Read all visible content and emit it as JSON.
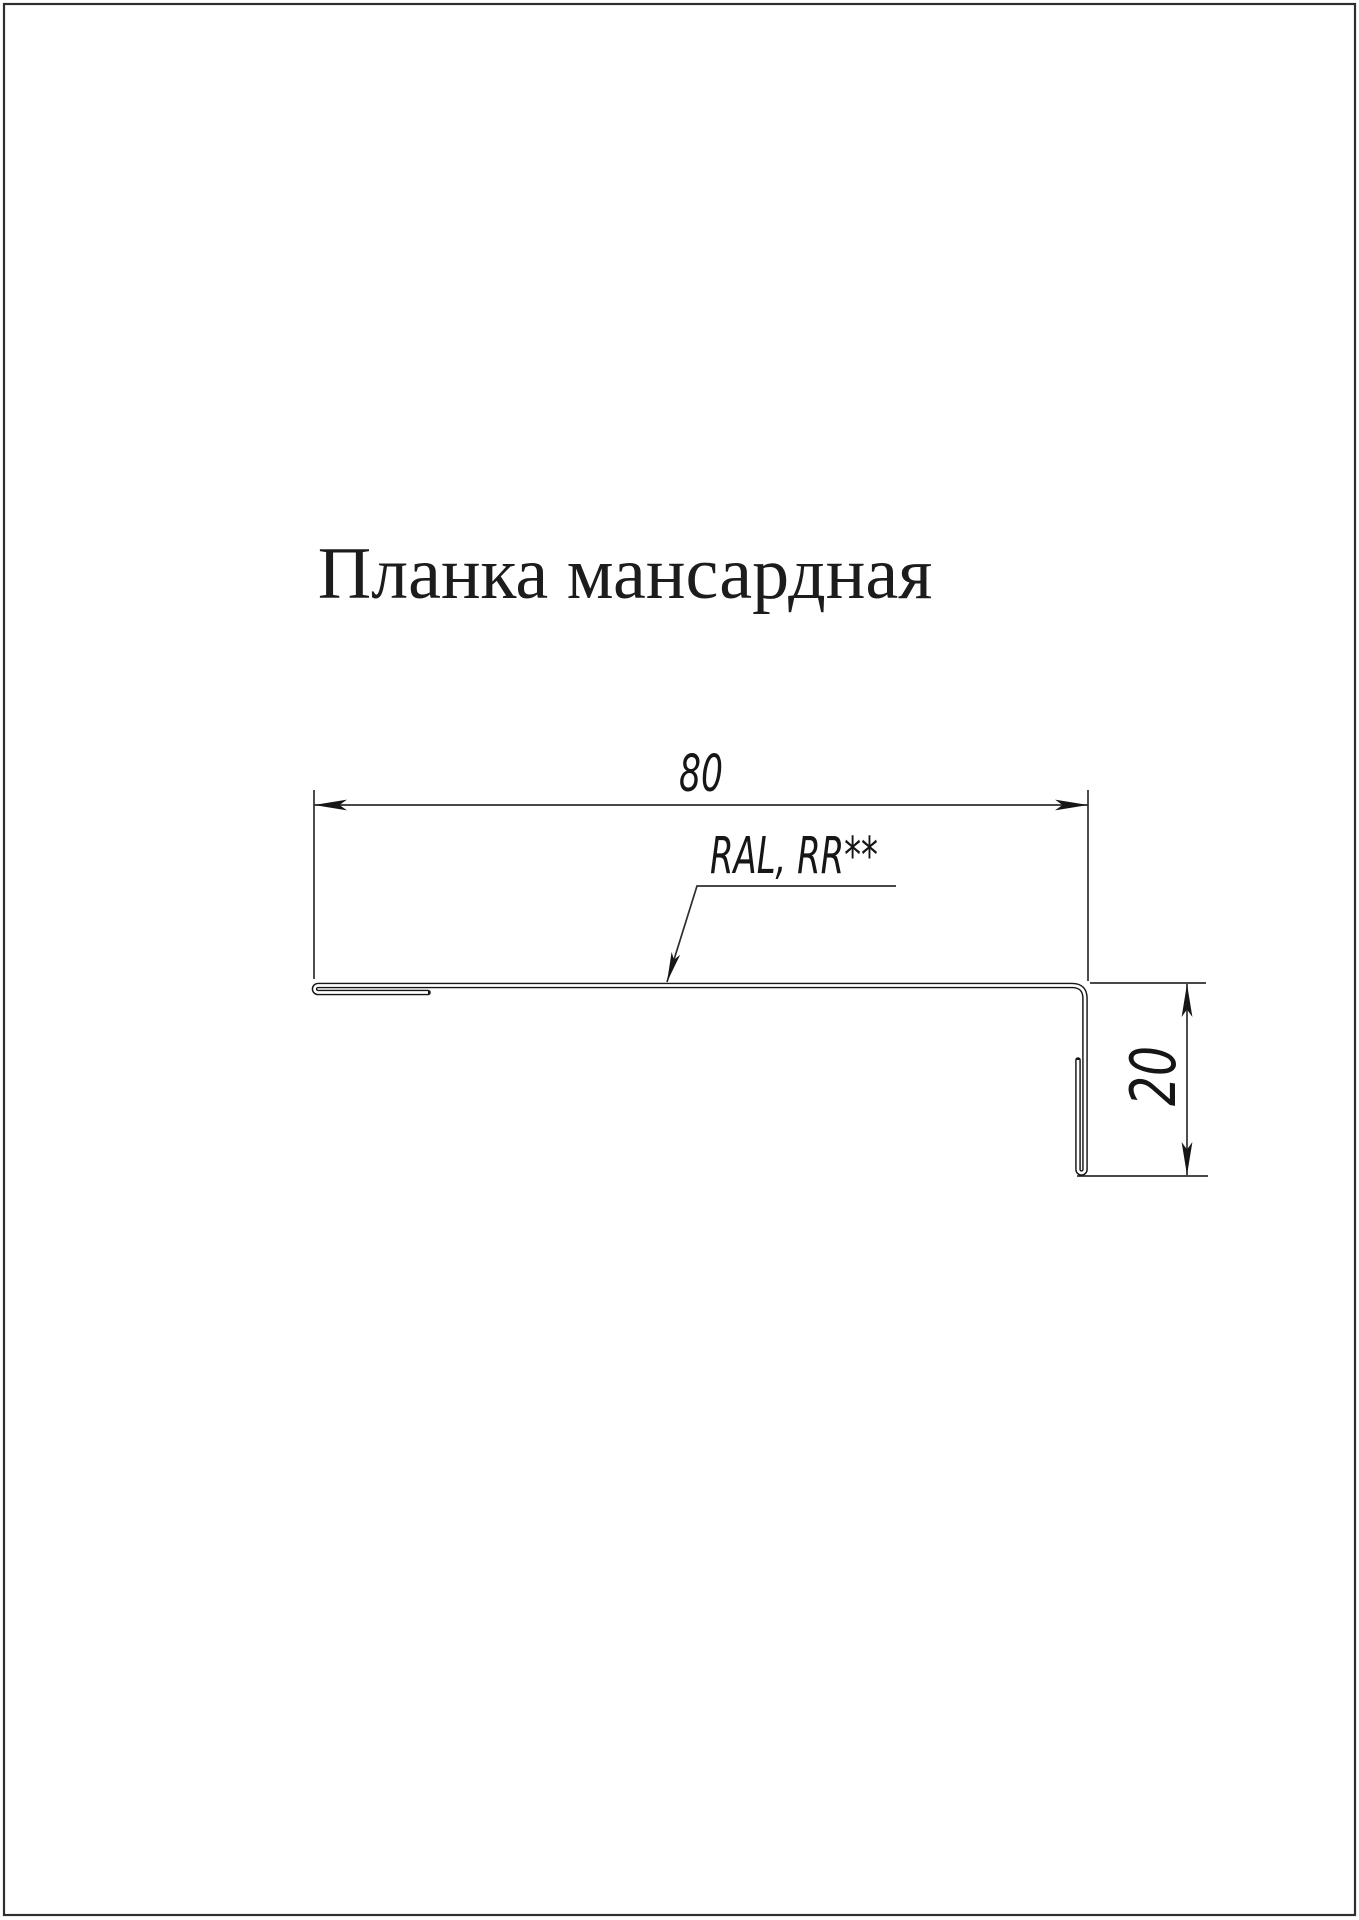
{
  "page": {
    "background": "#ffffff",
    "border_color": "#2e2e2e"
  },
  "title": "Планка мансардная",
  "drawing": {
    "part": "profile-cross-section",
    "width_dimension": "80",
    "height_dimension": "20",
    "coating_label": "RAL, RR**",
    "line_color": "#161616",
    "thin_line_color": "#2e2e2e",
    "text_color": "#1c1c1c"
  }
}
